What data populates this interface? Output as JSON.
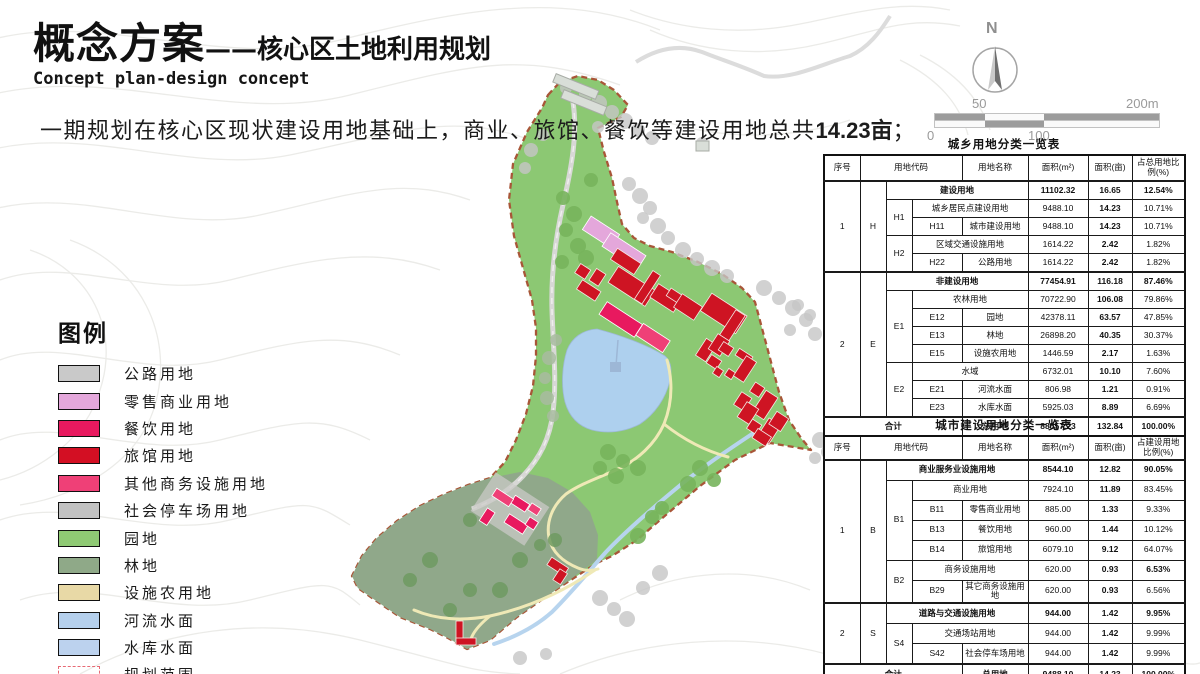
{
  "title": {
    "main": "概念方案",
    "sub": "——核心区土地利用规划",
    "en": "Concept plan-design concept"
  },
  "intro": {
    "before": "一期规划在核心区现状建设用地基础上，商业、旅馆、餐饮等建设用地总共",
    "highlight": "14.23亩",
    "after": "；"
  },
  "compass": {
    "north_label": "N"
  },
  "scalebar": {
    "top_left": "50",
    "top_right": "200m",
    "bottom_left": "0",
    "bottom_mid": "100"
  },
  "legend": {
    "title": "图例",
    "items": [
      {
        "label": "公路用地",
        "color": "#c9c9c9",
        "type": "fill"
      },
      {
        "label": "零售商业用地",
        "color": "#e4a7db",
        "type": "fill"
      },
      {
        "label": "餐饮用地",
        "color": "#e8195f",
        "type": "fill"
      },
      {
        "label": "旅馆用地",
        "color": "#d30f23",
        "type": "fill"
      },
      {
        "label": "其他商务设施用地",
        "color": "#ef4077",
        "type": "fill"
      },
      {
        "label": "社会停车场用地",
        "color": "#c2c2c2",
        "type": "fill"
      },
      {
        "label": "园地",
        "color": "#8fca74",
        "type": "fill"
      },
      {
        "label": "林地",
        "color": "#8fa988",
        "type": "fill"
      },
      {
        "label": "设施农用地",
        "color": "#e8d9a6",
        "type": "fill"
      },
      {
        "label": "河流水面",
        "color": "#b5d0ed",
        "type": "fill"
      },
      {
        "label": "水库水面",
        "color": "#bcd2ee",
        "type": "fill"
      },
      {
        "label": "规划范围",
        "color": "#ffffff",
        "type": "dashed",
        "border": "#e76a75"
      }
    ]
  },
  "table1": {
    "title": "城乡用地分类一览表",
    "col_widths": [
      36,
      26,
      26,
      50,
      66,
      60,
      44,
      53
    ],
    "header": [
      {
        "t": "序号"
      },
      {
        "t": "用地代码",
        "cs": 3
      },
      {
        "t": "用地名称"
      },
      {
        "t": "面积(m²)"
      },
      {
        "t": "面积(亩)"
      },
      {
        "t": "占总用地比例(%)"
      }
    ],
    "rows": [
      {
        "hv": true,
        "cells": [
          {
            "t": "1",
            "rs": 5
          },
          {
            "t": "H",
            "rs": 5
          },
          {
            "t": "建设用地",
            "cs": 3,
            "b": true
          },
          {
            "t": "11102.32",
            "b": true
          },
          {
            "t": "16.65",
            "b": true
          },
          {
            "t": "12.54%",
            "b": true
          }
        ]
      },
      {
        "cells": [
          {
            "t": "H1",
            "rs": 2
          },
          {
            "t": "城乡居民点建设用地",
            "cs": 2
          },
          {
            "t": "9488.10"
          },
          {
            "t": "14.23",
            "b": true
          },
          {
            "t": "10.71%"
          }
        ]
      },
      {
        "cells": [
          {
            "t": "H11"
          },
          {
            "t": "城市建设用地"
          },
          {
            "t": "9488.10"
          },
          {
            "t": "14.23",
            "b": true
          },
          {
            "t": "10.71%"
          }
        ]
      },
      {
        "cells": [
          {
            "t": "H2",
            "rs": 2
          },
          {
            "t": "区域交通设施用地",
            "cs": 2
          },
          {
            "t": "1614.22"
          },
          {
            "t": "2.42",
            "b": true
          },
          {
            "t": "1.82%"
          }
        ]
      },
      {
        "cells": [
          {
            "t": "H22"
          },
          {
            "t": "公路用地"
          },
          {
            "t": "1614.22"
          },
          {
            "t": "2.42",
            "b": true
          },
          {
            "t": "1.82%"
          }
        ]
      },
      {
        "hv": true,
        "cells": [
          {
            "t": "2",
            "rs": 8
          },
          {
            "t": "E",
            "rs": 8
          },
          {
            "t": "非建设用地",
            "cs": 3,
            "b": true
          },
          {
            "t": "77454.91",
            "b": true
          },
          {
            "t": "116.18",
            "b": true
          },
          {
            "t": "87.46%",
            "b": true
          }
        ]
      },
      {
        "cells": [
          {
            "t": "E1",
            "rs": 4
          },
          {
            "t": "农林用地",
            "cs": 2
          },
          {
            "t": "70722.90"
          },
          {
            "t": "106.08",
            "b": true
          },
          {
            "t": "79.86%"
          }
        ]
      },
      {
        "cells": [
          {
            "t": "E12"
          },
          {
            "t": "园地"
          },
          {
            "t": "42378.11"
          },
          {
            "t": "63.57",
            "b": true
          },
          {
            "t": "47.85%"
          }
        ]
      },
      {
        "cells": [
          {
            "t": "E13"
          },
          {
            "t": "林地"
          },
          {
            "t": "26898.20"
          },
          {
            "t": "40.35",
            "b": true
          },
          {
            "t": "30.37%"
          }
        ]
      },
      {
        "cells": [
          {
            "t": "E15"
          },
          {
            "t": "设施农用地"
          },
          {
            "t": "1446.59"
          },
          {
            "t": "2.17",
            "b": true
          },
          {
            "t": "1.63%"
          }
        ]
      },
      {
        "cells": [
          {
            "t": "E2",
            "rs": 3
          },
          {
            "t": "水域",
            "cs": 2
          },
          {
            "t": "6732.01"
          },
          {
            "t": "10.10",
            "b": true
          },
          {
            "t": "7.60%"
          }
        ]
      },
      {
        "cells": [
          {
            "t": "E21"
          },
          {
            "t": "河流水面"
          },
          {
            "t": "806.98"
          },
          {
            "t": "1.21",
            "b": true
          },
          {
            "t": "0.91%"
          }
        ]
      },
      {
        "cells": [
          {
            "t": "E23"
          },
          {
            "t": "水库水面"
          },
          {
            "t": "5925.03"
          },
          {
            "t": "8.89",
            "b": true
          },
          {
            "t": "6.69%"
          }
        ]
      },
      {
        "hv": true,
        "cells": [
          {
            "t": "合计",
            "cs": 4,
            "b": true
          },
          {
            "t": "总用地",
            "b": true
          },
          {
            "t": "88557.23",
            "b": true
          },
          {
            "t": "132.84",
            "b": true
          },
          {
            "t": "100.00%",
            "b": true
          }
        ]
      }
    ]
  },
  "table2": {
    "title": "城市建设用地分类一览表",
    "col_widths": [
      36,
      26,
      26,
      50,
      66,
      60,
      44,
      53
    ],
    "header": [
      {
        "t": "序号"
      },
      {
        "t": "用地代码",
        "cs": 3
      },
      {
        "t": "用地名称"
      },
      {
        "t": "面积(m²)"
      },
      {
        "t": "面积(亩)"
      },
      {
        "t": "占建设用地比例(%)"
      }
    ],
    "rows": [
      {
        "hv": true,
        "cells": [
          {
            "t": "1",
            "rs": 7
          },
          {
            "t": "B",
            "rs": 7
          },
          {
            "t": "商业服务业设施用地",
            "cs": 3,
            "b": true
          },
          {
            "t": "8544.10",
            "b": true
          },
          {
            "t": "12.82",
            "b": true
          },
          {
            "t": "90.05%",
            "b": true
          }
        ]
      },
      {
        "cells": [
          {
            "t": "B1",
            "rs": 4
          },
          {
            "t": "商业用地",
            "cs": 2
          },
          {
            "t": "7924.10"
          },
          {
            "t": "11.89",
            "b": true
          },
          {
            "t": "83.45%"
          }
        ]
      },
      {
        "cells": [
          {
            "t": "B11"
          },
          {
            "t": "零售商业用地"
          },
          {
            "t": "885.00"
          },
          {
            "t": "1.33",
            "b": true
          },
          {
            "t": "9.33%"
          }
        ]
      },
      {
        "cells": [
          {
            "t": "B13"
          },
          {
            "t": "餐饮用地"
          },
          {
            "t": "960.00"
          },
          {
            "t": "1.44",
            "b": true
          },
          {
            "t": "10.12%"
          }
        ]
      },
      {
        "cells": [
          {
            "t": "B14"
          },
          {
            "t": "旅馆用地"
          },
          {
            "t": "6079.10"
          },
          {
            "t": "9.12",
            "b": true
          },
          {
            "t": "64.07%"
          }
        ]
      },
      {
        "cells": [
          {
            "t": "B2",
            "rs": 2
          },
          {
            "t": "商务设施用地",
            "cs": 2
          },
          {
            "t": "620.00"
          },
          {
            "t": "0.93",
            "b": true
          },
          {
            "t": "6.53%",
            "b": true
          }
        ]
      },
      {
        "cells": [
          {
            "t": "B29"
          },
          {
            "t": "其它商务设施用地"
          },
          {
            "t": "620.00"
          },
          {
            "t": "0.93",
            "b": true
          },
          {
            "t": "6.56%"
          }
        ]
      },
      {
        "hv": true,
        "cells": [
          {
            "t": "2",
            "rs": 3
          },
          {
            "t": "S",
            "rs": 3
          },
          {
            "t": "道路与交通设施用地",
            "cs": 3,
            "b": true
          },
          {
            "t": "944.00",
            "b": true
          },
          {
            "t": "1.42",
            "b": true
          },
          {
            "t": "9.95%",
            "b": true
          }
        ]
      },
      {
        "cells": [
          {
            "t": "S4",
            "rs": 2
          },
          {
            "t": "交通场站用地",
            "cs": 2
          },
          {
            "t": "944.00"
          },
          {
            "t": "1.42",
            "b": true
          },
          {
            "t": "9.99%"
          }
        ]
      },
      {
        "cells": [
          {
            "t": "S42"
          },
          {
            "t": "社会停车场用地"
          },
          {
            "t": "944.00"
          },
          {
            "t": "1.42",
            "b": true
          },
          {
            "t": "9.99%"
          }
        ]
      },
      {
        "hv": true,
        "cells": [
          {
            "t": "合计",
            "cs": 4,
            "b": true
          },
          {
            "t": "总用地",
            "b": true
          },
          {
            "t": "9488.10",
            "b": true
          },
          {
            "t": "14.23",
            "b": true
          },
          {
            "t": "100.00%",
            "b": true
          }
        ]
      }
    ]
  }
}
